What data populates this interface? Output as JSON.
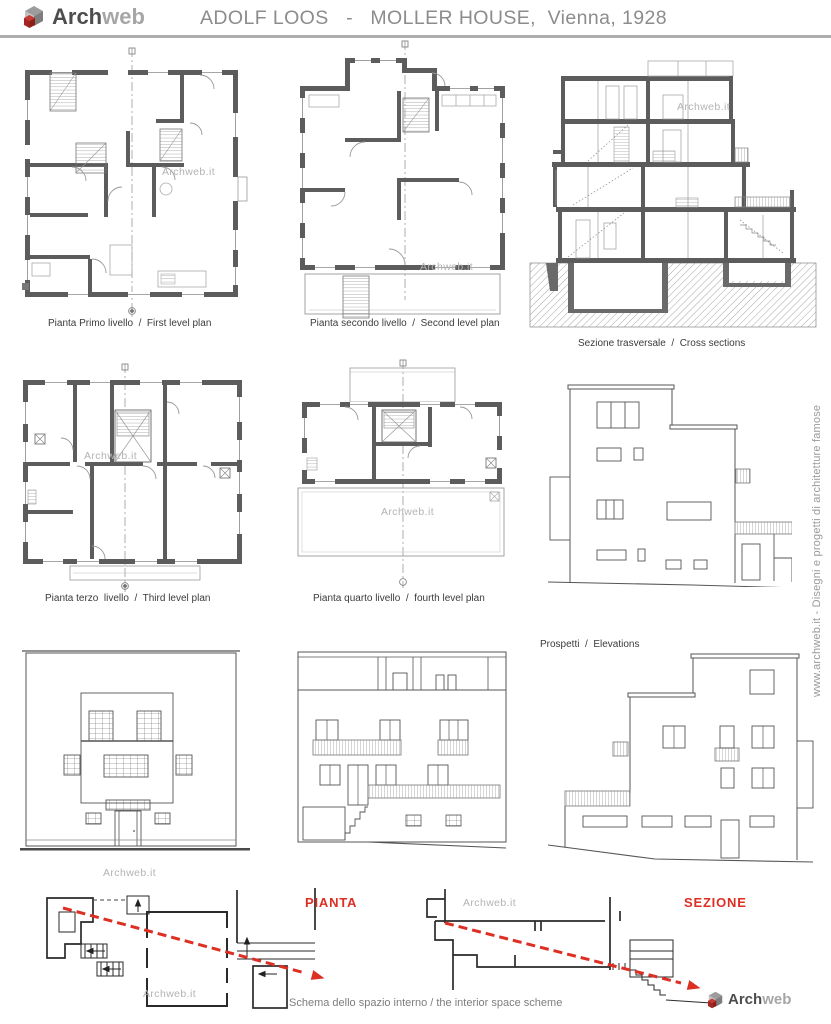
{
  "header": {
    "logo_primary": "Arch",
    "logo_secondary": "web",
    "title": "ADOLF LOOS   -   MOLLER HOUSE,  Vienna, 1928"
  },
  "side_text": "www.archweb.it - Disegni e progetti di architetture famose",
  "watermark": "Archweb.it",
  "figures": {
    "plan1_caption": "Pianta Primo livello  /  First level plan",
    "plan2_caption": "Pianta secondo livello  /  Second level plan",
    "section_caption": "Sezione trasversale  /  Cross sections",
    "plan3_caption": "Pianta terzo  livello  /  Third level plan",
    "plan4_caption": "Pianta quarto livello  /  fourth level plan",
    "elevations_caption": "Prospetti  /  Elevations",
    "schema_caption": "Schema dello spazio interno / the interior space scheme",
    "schema_plan_label": "PIANTA",
    "schema_section_label": "SEZIONE"
  },
  "footer": {
    "logo_primary": "Arch",
    "logo_secondary": "web"
  },
  "colors": {
    "accent_red": "#dd2f23",
    "logo_red": "#a82420",
    "wall_gray": "#5c5c5c",
    "title_gray": "#8c8c8c",
    "caption_gray": "#3b3b3b",
    "watermark_gray": "#b3b3b3"
  }
}
